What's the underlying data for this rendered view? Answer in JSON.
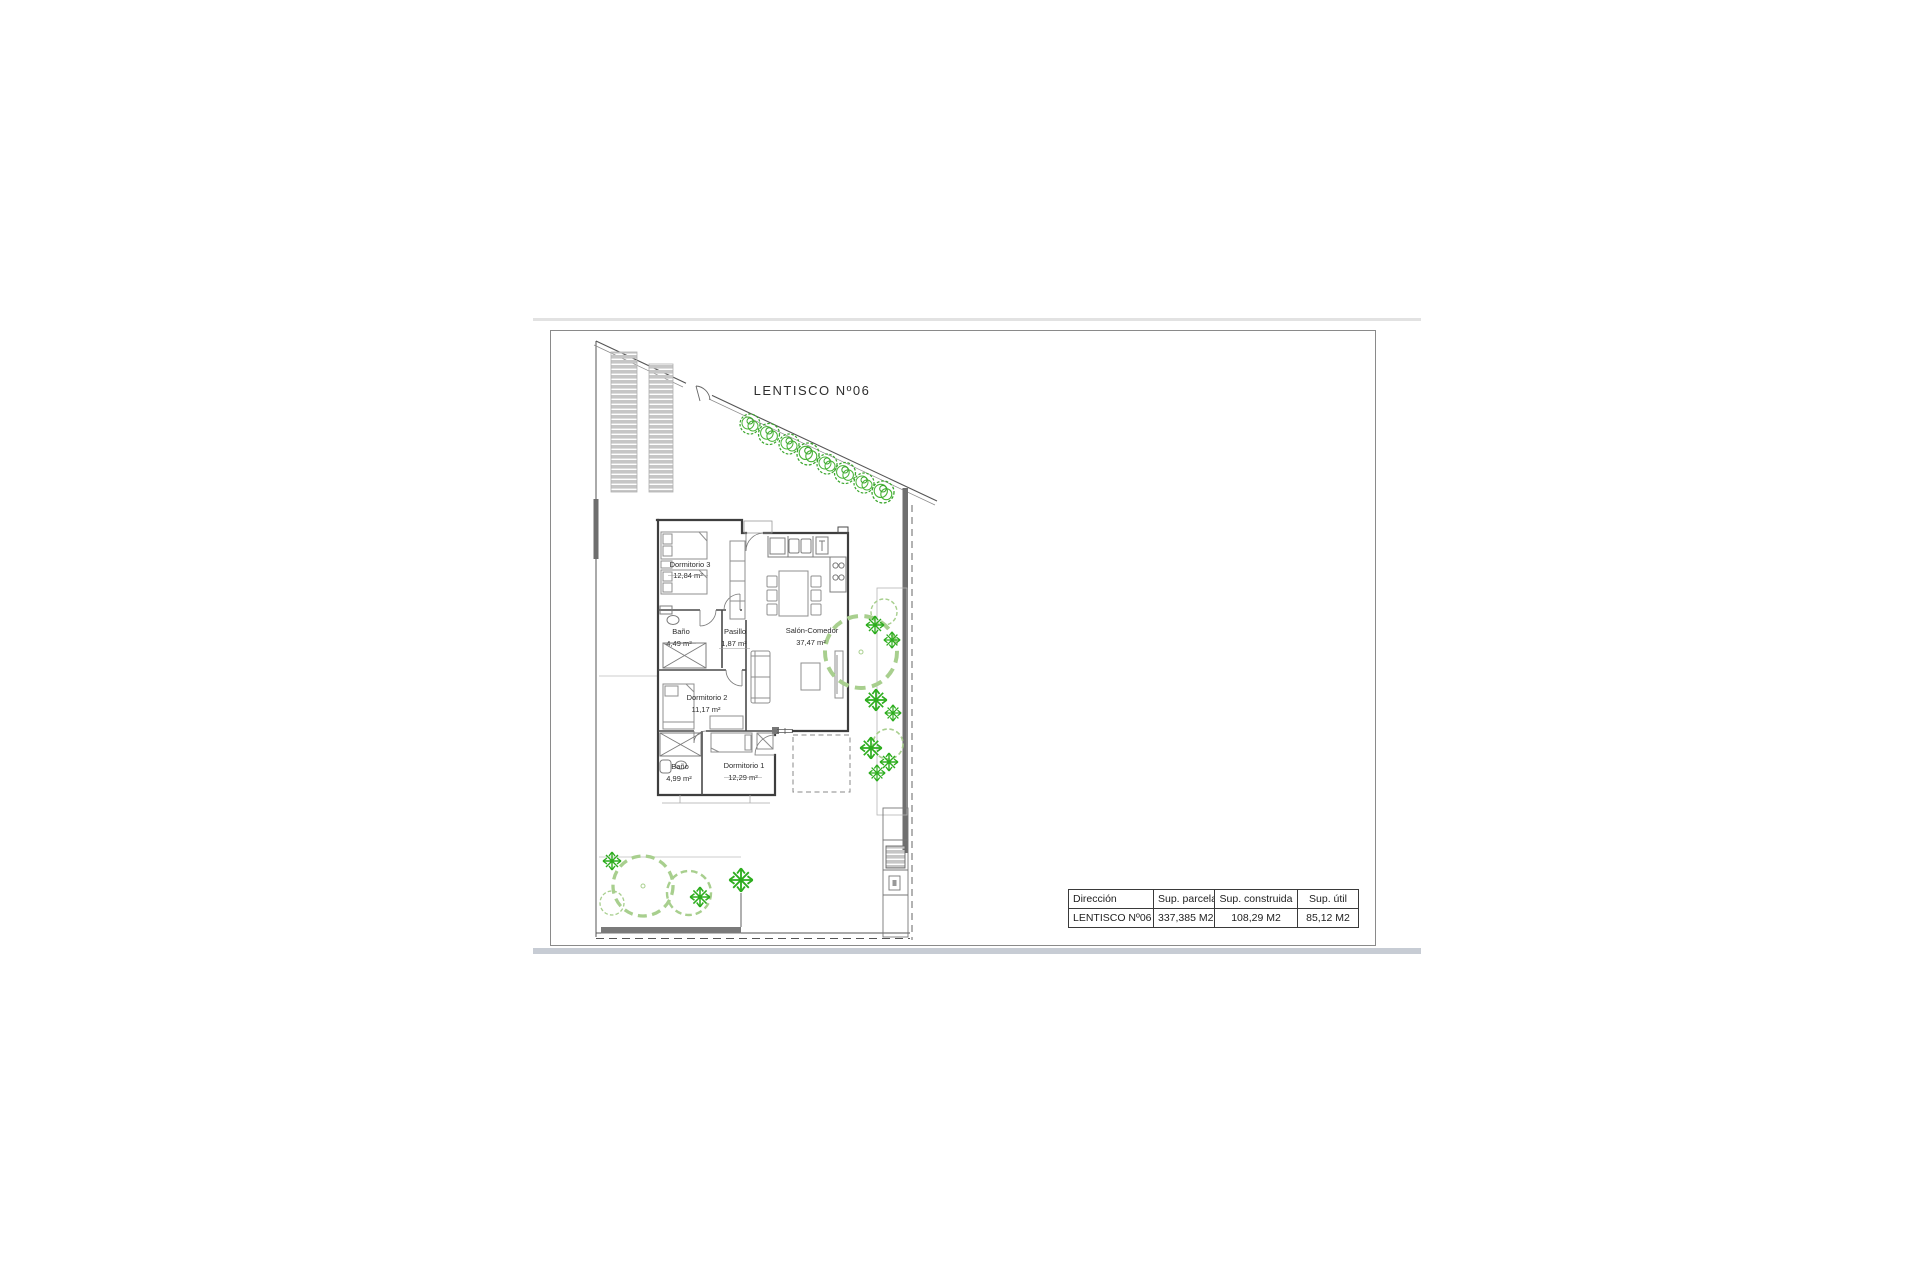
{
  "page": {
    "street_label": "LENTISCO  Nº06"
  },
  "plan": {
    "rooms": [
      {
        "name": "Dormitorio 3",
        "area": "12,84 m²"
      },
      {
        "name": "Baño",
        "area": "4,49 m²"
      },
      {
        "name": "Pasillo",
        "area": "1,87 m²"
      },
      {
        "name": "Salón-Comedor",
        "area": "37,47 m²"
      },
      {
        "name": "Dormitorio 2",
        "area": "11,17 m²"
      },
      {
        "name": "Baño",
        "area": "4,99 m²"
      },
      {
        "name": "Dormitorio 1",
        "area": "12,29 m²"
      }
    ],
    "colors": {
      "tree_green": "#3aa62c",
      "shrub_green": "#2dad1e",
      "bush_green": "#a8cf8e",
      "boundary_wall_gray": "#6f6f6f",
      "slat_gray": "#c6c6c6"
    }
  },
  "summary_table": {
    "headers": [
      "Dirección",
      "Sup. parcela",
      "Sup. construida",
      "Sup. útil"
    ],
    "row": [
      "LENTISCO Nº06",
      "337,385 M2",
      "108,29 M2",
      "85,12 M2"
    ]
  }
}
